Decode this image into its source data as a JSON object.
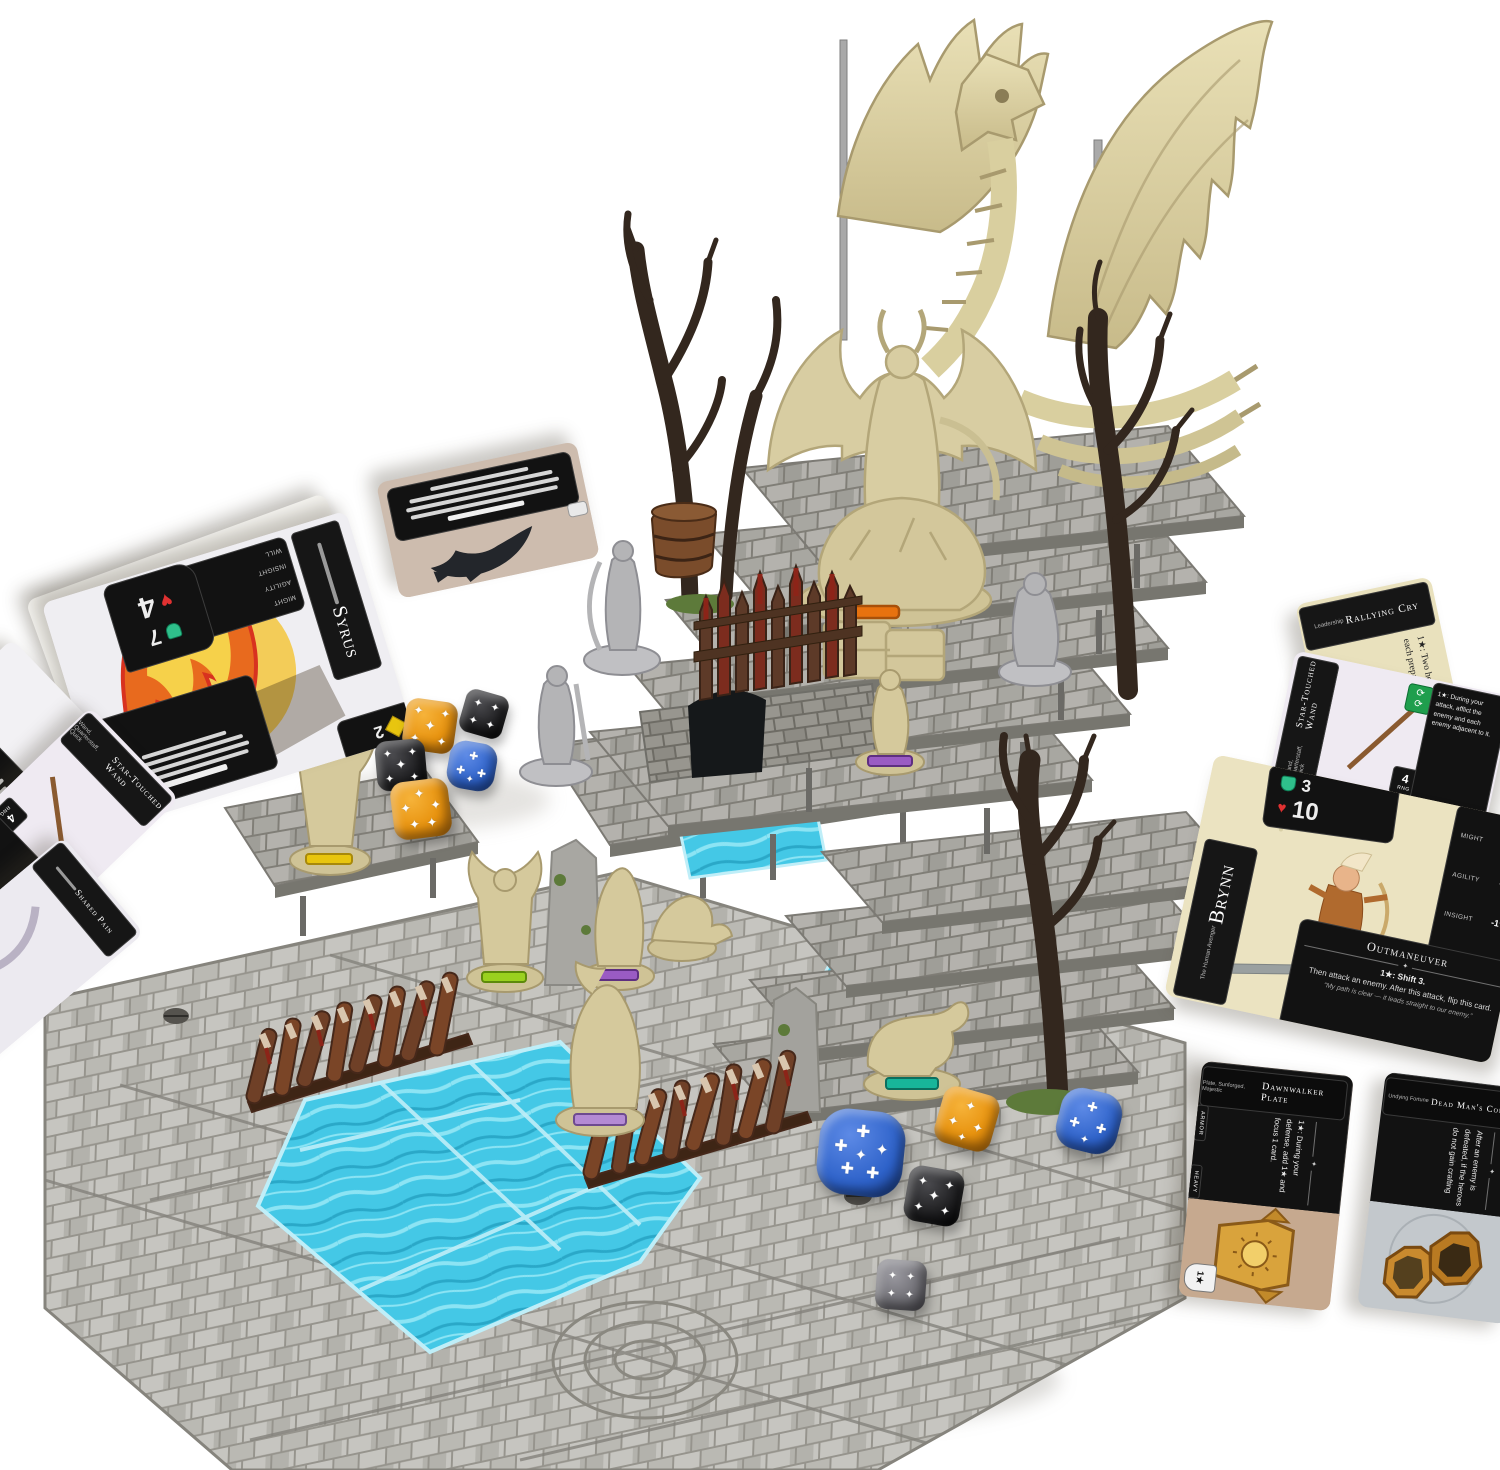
{
  "scene": {
    "background": "#ffffff",
    "subject": "Dungeon-crawler board game setup: modular stone terrain with staircases, skeletal dragon centerpiece, bone-colored monster and gray hero miniatures, water tiles, spiked barricades, hero and item cards, star-pip dice"
  },
  "glyphs": {
    "star_pip": "✦",
    "cross_pip": "✚",
    "heart": "♥",
    "star": "★",
    "diamond": "◆"
  },
  "cards": {
    "brynn": {
      "name": "Brynn",
      "subtitle": "The Human Avenger",
      "gem_value": "3",
      "heart_value": "10",
      "stats": [
        {
          "label": "Might",
          "value": "+2★"
        },
        {
          "label": "Agility",
          "value": "-1★"
        },
        {
          "label": "Insight",
          "value": "-1★"
        },
        {
          "label": "Will",
          "value": "+1★"
        }
      ],
      "ability_title": "Outmaneuver",
      "ability_cost": "1★: Shift 3.",
      "ability_text": "Then attack an enemy. After this attack, flip this card.",
      "flavor_text": "“My path is clear — it leads straight to our enemy.”"
    },
    "syrus": {
      "name": "Syrus",
      "heart_value": "4",
      "gem_value": "7",
      "corner_value": "2",
      "stats": [
        {
          "label": "Might",
          "value": "+2★"
        },
        {
          "label": "Agility",
          "value": "-1★"
        },
        {
          "label": "Insight",
          "value": "-1★"
        },
        {
          "label": "Will",
          "value": "+1★"
        }
      ]
    },
    "star_touched_wand": {
      "title": "Star-Touched Wand",
      "subtitle": "Wand, Quarterstaff, Quick",
      "ability_text": "1★: During your attack, afflict the enemy and each enemy adjacent to it.",
      "range_value": "4",
      "range_label": "RNG",
      "reroll_icon": "⟳",
      "defense_icon": "✕",
      "defense_value": "2★"
    },
    "rallying_cry": {
      "title": "Rallying Cry",
      "subtitle": "Leadership",
      "ability_text": "1★: Two heroes within 3 spaces of you may each prepare 1 card."
    },
    "shared_pain": {
      "title": "Shared Pain"
    },
    "dawnwalker_plate": {
      "title": "Dawnwalker Plate",
      "subtitle": "Plate, Sunforged, Majestic",
      "ability_text": "1★: During your defense, add 1★ and focus 1 card.",
      "tag_armor": "Armor",
      "tag_heavy": "Heavy",
      "shield_value": "1★"
    },
    "dead_mans_compass": {
      "title": "Dead Man's Compass",
      "subtitle": "Undying Fortune",
      "ability_text": "After an enemy is defeated, if the heroes do not gain crafting"
    }
  },
  "colors": {
    "stone": "#c3c2be",
    "stone_dark": "#8f8e8a",
    "water": "#44c8e6",
    "bone": "#ded3a6",
    "tree": "#33271e",
    "card_cream": "#ebe3c1",
    "blood": "#8c2418",
    "barricade": "#6f4027",
    "orange_die": "#e8930f",
    "blue_die": "#2e62c9",
    "black_die": "#1d1d1f",
    "gray_die": "#6e6d73",
    "pip": "#ffffff"
  }
}
